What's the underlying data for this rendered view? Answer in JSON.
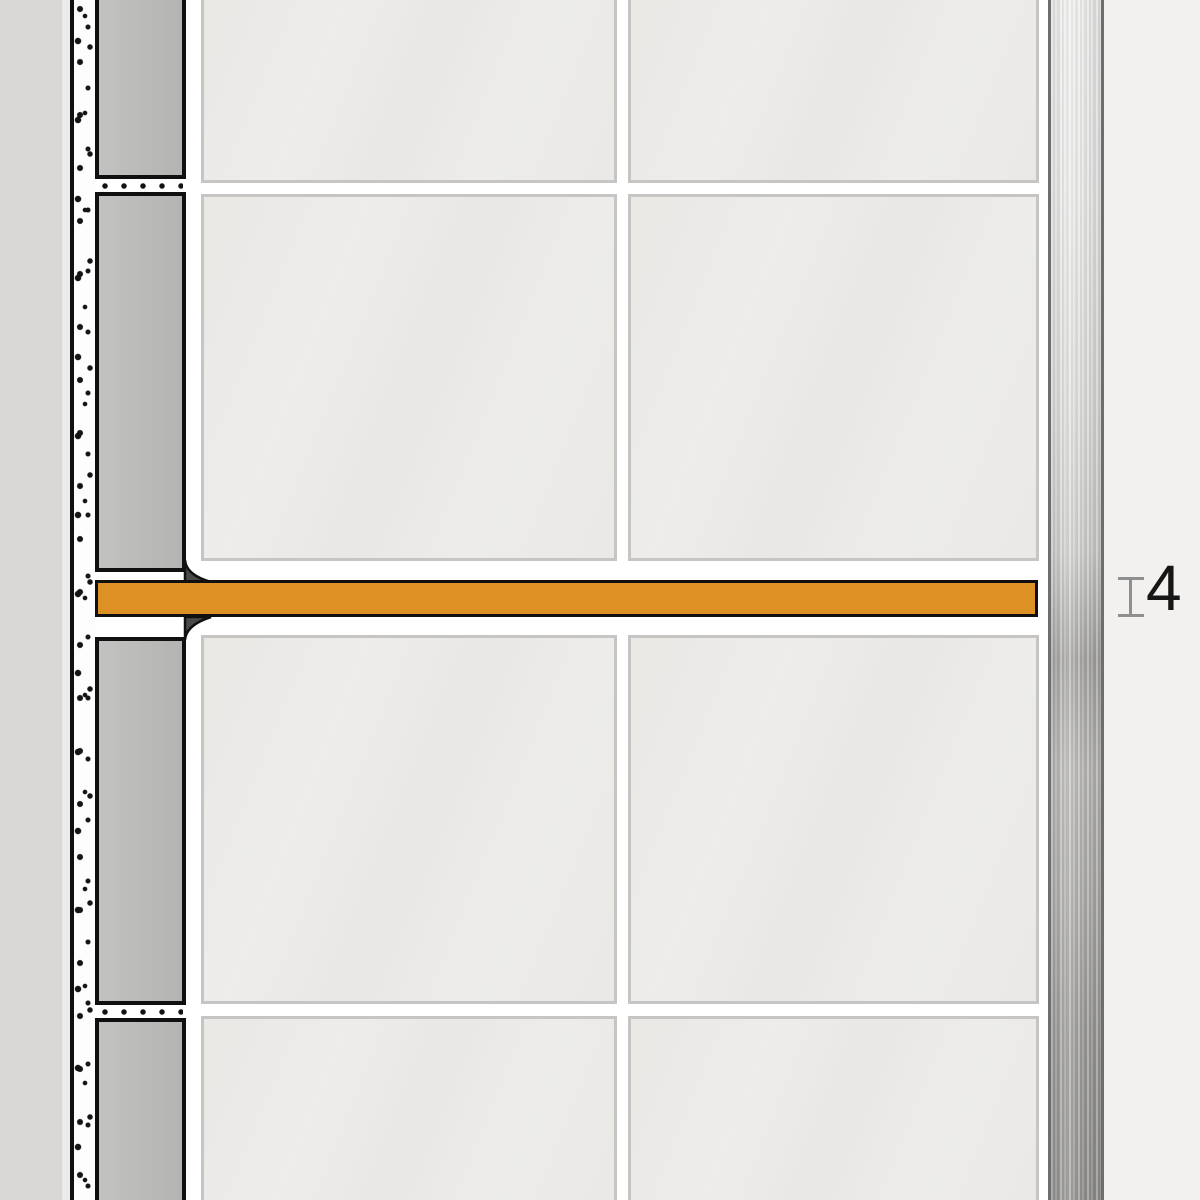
{
  "dimension": {
    "value": "4"
  },
  "icons": {
    "dimension_extent_icon": "vertical I-beam extent marker (css rectangles)",
    "profile_anchor_fillet_icon": "dark concave wedge where profile meets wall joint (svg path)"
  },
  "colors": {
    "background": "#F2F1F0",
    "wall_substrate": "#D9D8D7",
    "wall_highlight": "#EBEBEA",
    "outline": "#101010",
    "mortar_bg": "#FDFDFD",
    "block_gray": "#BABAB9",
    "tile_face": "#EFEEEC",
    "tile_edge": "#C6C5C4",
    "grout": "#FFFFFF",
    "profile_orange": "#DE9226",
    "anchor_dark": "#4A4A4A",
    "steel_edge": "#6E6E6E",
    "dimension_mark": "#8F8F8F",
    "text": "#161616"
  },
  "scene": {
    "description_counts": {
      "front_tile_rows": 4,
      "front_tile_columns": 2,
      "wall_cross_section_blocks": 4
    }
  }
}
